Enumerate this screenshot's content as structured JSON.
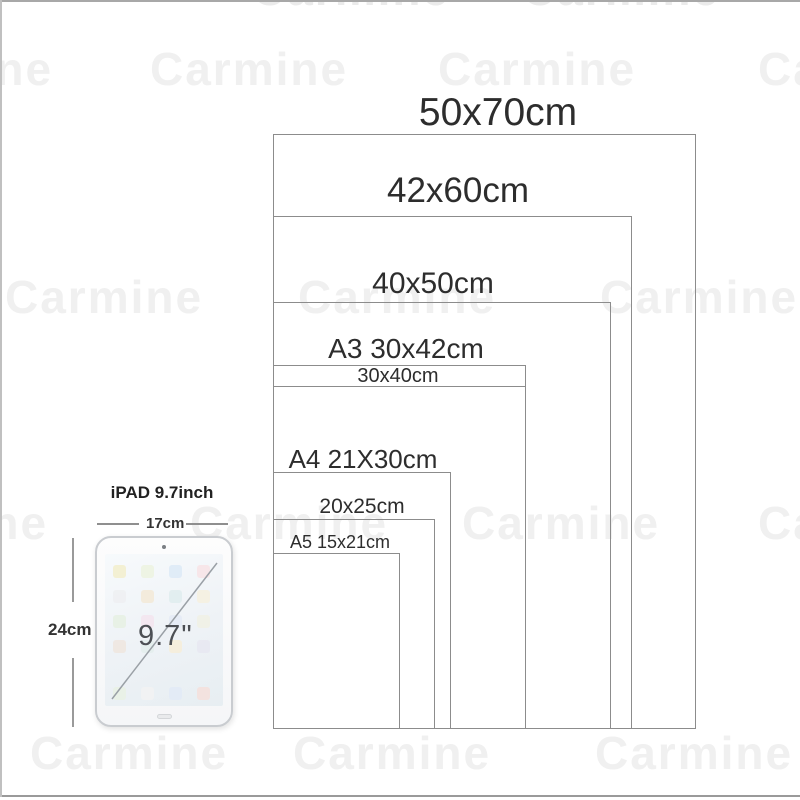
{
  "watermark": {
    "text": "Carmine"
  },
  "diagram": {
    "title_note": "poster frame size comparison",
    "border_color": "#8c8c8c",
    "sizes": [
      {
        "label": "50x70cm",
        "width_cm": 50,
        "height_cm": 70
      },
      {
        "label": "42x60cm",
        "width_cm": 42,
        "height_cm": 60
      },
      {
        "label": "40x50cm",
        "width_cm": 40,
        "height_cm": 50
      },
      {
        "label": "A3 30x42cm",
        "width_cm": 30,
        "height_cm": 42
      },
      {
        "label": "30x40cm",
        "width_cm": 30,
        "height_cm": 40
      },
      {
        "label": "A4 21X30cm",
        "width_cm": 21,
        "height_cm": 30
      },
      {
        "label": "20x25cm",
        "width_cm": 20,
        "height_cm": 25
      },
      {
        "label": "A5 15x21cm",
        "width_cm": 15,
        "height_cm": 21
      }
    ]
  },
  "ipad": {
    "title": "iPAD 9.7inch",
    "width_label": "17cm",
    "height_label": "24cm",
    "diagonal_label": "9.7\"",
    "app_icon_colors": [
      "#f3edc9",
      "#ecf2df",
      "#dbe8f6",
      "#f8e2e5",
      "#edeff1",
      "#f2e8d4",
      "#dfecee",
      "#f6f0dd",
      "#e6f0e1",
      "#f4e4ee",
      "#e3eaf5",
      "#f0f0e3",
      "#efe5dd",
      "#e2eeec",
      "#f6edd7",
      "#e7e7f1"
    ],
    "dock_icon_colors": [
      "#e8f1e3",
      "#f2f2f2",
      "#e1eaf6",
      "#f5ded9"
    ]
  }
}
